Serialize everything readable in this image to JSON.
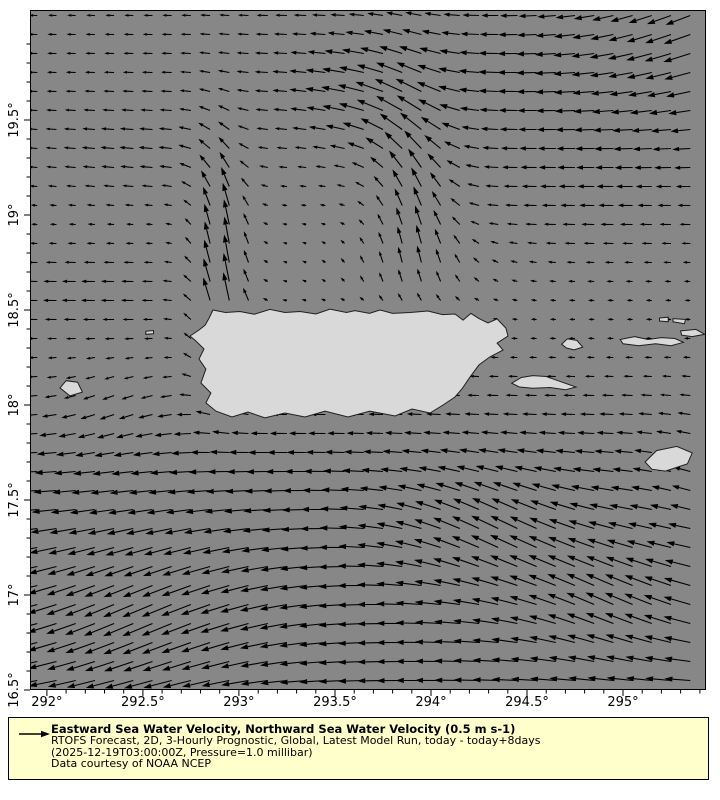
{
  "colors": {
    "page_bg": "#ffffff",
    "sea": "#878787",
    "land": "#d9d9d9",
    "coastline": "#1f1f1f",
    "arrow": "#000000",
    "axis": "#000000",
    "legend_bg": "#ffffcc",
    "legend_border": "#000000",
    "text": "#000000"
  },
  "legend": {
    "title": "Eastward Sea Water Velocity, Northward Sea Water Velocity (0.5 m s-1)",
    "line2": "RTOFS Forecast, 2D, 3-Hourly Prognostic, Global, Latest Model Run, today - today+8days",
    "line3": "(2025-12-19T03:00:00Z, Pressure=1.0 millibar)",
    "line4": "Data courtesy of NOAA NCEP",
    "reference_speed_ms": 0.5
  },
  "chart_data": {
    "type": "quiver",
    "title": "",
    "xlabel": "",
    "ylabel": "",
    "grid": false,
    "x_axis": {
      "range": [
        291.912,
        295.432
      ],
      "tick_values": [
        292,
        292.5,
        293,
        293.5,
        294,
        294.5,
        295
      ],
      "tick_labels": [
        "292°",
        "292.5°",
        "293°",
        "293.5°",
        "294°",
        "294.5°",
        "295°"
      ],
      "minor_step": 0.1
    },
    "y_axis": {
      "range": [
        16.5,
        20.079
      ],
      "tick_values": [
        16.5,
        17,
        17.5,
        18,
        18.5,
        19,
        19.5
      ],
      "tick_labels": [
        "16.5°",
        "17°",
        "17.5°",
        "18°",
        "18.5°",
        "19°",
        "19.5°"
      ],
      "minor_step": 0.1
    },
    "vector_grid": {
      "lon_start": 291.95,
      "lon_step": 0.1,
      "lon_count": 35,
      "lat_start": 16.55,
      "lat_step": 0.1,
      "lat_count": 36
    },
    "arrow_scale_px_per_ms": 50,
    "field": {
      "background": {
        "u": -0.07,
        "v": 0.005
      },
      "features": [
        {
          "name": "caribbean-current",
          "type": "sigband_u",
          "A": -0.44,
          "lat0": 17.95,
          "r": 0.2
        },
        {
          "name": "sw-veer-bottom-left",
          "type": "gauss",
          "lon0": 292.5,
          "lat0": 16.9,
          "sx": 0.8,
          "sy": 0.5,
          "Au": -0.1,
          "Av": -0.26
        },
        {
          "name": "nw-band-southeast-1",
          "type": "gauss",
          "lon0": 294.35,
          "lat0": 17.35,
          "sx": 0.55,
          "sy": 0.33,
          "Au": -0.05,
          "Av": 0.24
        },
        {
          "name": "nw-band-southeast-2",
          "type": "gauss",
          "lon0": 295.0,
          "lat0": 16.95,
          "sx": 0.55,
          "sy": 0.33,
          "Au": -0.05,
          "Av": 0.22
        },
        {
          "name": "mona-passage-jet",
          "type": "jet_v",
          "A": 0.62,
          "lon0": 292.92,
          "sx": 0.14,
          "lat1": 18.15,
          "r1": 0.12,
          "lat2": 19.25,
          "r2": 0.18
        },
        {
          "name": "mona-jet-west-turn-low",
          "type": "gauss",
          "lon0": 292.2,
          "lat0": 18.6,
          "sx": 0.55,
          "sy": 0.25,
          "Au": -0.2,
          "Av": 0.0
        },
        {
          "name": "mona-jet-west-turn-high",
          "type": "gauss",
          "lon0": 292.45,
          "lat0": 19.3,
          "sx": 0.6,
          "sy": 0.3,
          "Au": -0.16,
          "Av": 0.02
        },
        {
          "name": "north-jet",
          "type": "jet_v",
          "A": 0.5,
          "lon0": 293.93,
          "sx": 0.22,
          "lat1": 18.8,
          "r1": 0.15,
          "lat2": 19.5,
          "r2": 0.25
        },
        {
          "name": "north-jet-nw-turn",
          "type": "gauss",
          "lon0": 293.75,
          "lat0": 19.6,
          "sx": 0.4,
          "sy": 0.33,
          "Au": -0.28,
          "Av": 0.1
        },
        {
          "name": "north-jet-feed",
          "type": "gauss",
          "lon0": 293.9,
          "lat0": 18.72,
          "sx": 0.45,
          "sy": 0.22,
          "Au": 0.02,
          "Av": 0.14
        },
        {
          "name": "top-westward-band",
          "type": "topband_u",
          "base": 0.1,
          "amp": 0.27,
          "lonC": 293.8,
          "lonR": 0.6,
          "lat0": 19.85,
          "sy": 0.55
        },
        {
          "name": "ne-corner-inflow",
          "type": "gauss",
          "lon0": 295.45,
          "lat0": 20.0,
          "sx": 0.6,
          "sy": 0.45,
          "Au": -0.12,
          "Av": -0.2
        },
        {
          "name": "west-coast-south-drift",
          "type": "gauss",
          "lon0": 292.35,
          "lat0": 17.95,
          "sx": 0.35,
          "sy": 0.28,
          "Au": 0.0,
          "Av": -0.1
        },
        {
          "name": "east-offshore-westward",
          "type": "gauss",
          "lon0": 294.9,
          "lat0": 19.15,
          "sx": 0.8,
          "sy": 0.45,
          "Au": -0.2,
          "Av": 0.0
        },
        {
          "name": "se-edge-ne-drift",
          "type": "gauss",
          "lon0": 295.45,
          "lat0": 17.6,
          "sx": 0.35,
          "sy": 0.35,
          "Au": 0.1,
          "Av": 0.09
        }
      ]
    },
    "land": [
      {
        "name": "puerto-rico",
        "points": [
          [
            292.865,
            18.5
          ],
          [
            292.93,
            18.487
          ],
          [
            293.005,
            18.492
          ],
          [
            293.08,
            18.478
          ],
          [
            293.161,
            18.503
          ],
          [
            293.24,
            18.487
          ],
          [
            293.318,
            18.492
          ],
          [
            293.4,
            18.479
          ],
          [
            293.474,
            18.505
          ],
          [
            293.56,
            18.487
          ],
          [
            293.604,
            18.497
          ],
          [
            293.68,
            18.482
          ],
          [
            293.734,
            18.5
          ],
          [
            293.8,
            18.482
          ],
          [
            293.891,
            18.487
          ],
          [
            293.984,
            18.495
          ],
          [
            294.06,
            18.476
          ],
          [
            294.125,
            18.479
          ],
          [
            294.167,
            18.447
          ],
          [
            294.208,
            18.482
          ],
          [
            294.25,
            18.455
          ],
          [
            294.297,
            18.432
          ],
          [
            294.344,
            18.453
          ],
          [
            294.39,
            18.405
          ],
          [
            294.401,
            18.363
          ],
          [
            294.344,
            18.326
          ],
          [
            294.375,
            18.289
          ],
          [
            294.307,
            18.253
          ],
          [
            294.25,
            18.211
          ],
          [
            294.203,
            18.147
          ],
          [
            294.161,
            18.084
          ],
          [
            294.125,
            18.042
          ],
          [
            294.063,
            18.0
          ],
          [
            293.995,
            17.958
          ],
          [
            293.901,
            17.979
          ],
          [
            293.813,
            17.942
          ],
          [
            293.682,
            17.968
          ],
          [
            293.568,
            17.937
          ],
          [
            293.448,
            17.968
          ],
          [
            293.344,
            17.937
          ],
          [
            293.24,
            17.958
          ],
          [
            293.135,
            17.932
          ],
          [
            293.047,
            17.963
          ],
          [
            292.964,
            17.937
          ],
          [
            292.88,
            17.968
          ],
          [
            292.828,
            18.011
          ],
          [
            292.854,
            18.063
          ],
          [
            292.802,
            18.116
          ],
          [
            292.828,
            18.189
          ],
          [
            292.792,
            18.242
          ],
          [
            292.818,
            18.295
          ],
          [
            292.776,
            18.337
          ],
          [
            292.745,
            18.363
          ],
          [
            292.792,
            18.395
          ],
          [
            292.824,
            18.42
          ],
          [
            292.843,
            18.455
          ]
        ]
      },
      {
        "name": "mona-island",
        "points": [
          [
            292.068,
            18.09
          ],
          [
            292.1,
            18.128
          ],
          [
            292.16,
            18.12
          ],
          [
            292.185,
            18.068
          ],
          [
            292.12,
            18.048
          ]
        ]
      },
      {
        "name": "desecheo-island",
        "points": [
          [
            292.515,
            18.388
          ],
          [
            292.555,
            18.392
          ],
          [
            292.555,
            18.375
          ],
          [
            292.515,
            18.372
          ]
        ]
      },
      {
        "name": "vieques",
        "points": [
          [
            294.42,
            18.115
          ],
          [
            294.47,
            18.145
          ],
          [
            294.53,
            18.155
          ],
          [
            294.6,
            18.15
          ],
          [
            294.67,
            18.125
          ],
          [
            294.755,
            18.095
          ],
          [
            294.7,
            18.08
          ],
          [
            294.62,
            18.092
          ],
          [
            294.53,
            18.088
          ],
          [
            294.46,
            18.095
          ]
        ]
      },
      {
        "name": "culebra",
        "points": [
          [
            294.68,
            18.32
          ],
          [
            294.71,
            18.348
          ],
          [
            294.76,
            18.34
          ],
          [
            294.79,
            18.305
          ],
          [
            294.745,
            18.29
          ],
          [
            294.705,
            18.3
          ]
        ]
      },
      {
        "name": "st-thomas-st-john",
        "points": [
          [
            294.985,
            18.345
          ],
          [
            295.06,
            18.36
          ],
          [
            295.13,
            18.345
          ],
          [
            295.2,
            18.355
          ],
          [
            295.27,
            18.35
          ],
          [
            295.315,
            18.33
          ],
          [
            295.25,
            18.312
          ],
          [
            295.17,
            18.322
          ],
          [
            295.08,
            18.312
          ],
          [
            295.0,
            18.322
          ]
        ]
      },
      {
        "name": "tortola",
        "points": [
          [
            295.3,
            18.39
          ],
          [
            295.38,
            18.398
          ],
          [
            295.425,
            18.372
          ],
          [
            295.36,
            18.36
          ],
          [
            295.305,
            18.368
          ]
        ]
      },
      {
        "name": "jost-van-dyke",
        "points": [
          [
            295.19,
            18.458
          ],
          [
            295.235,
            18.462
          ],
          [
            295.235,
            18.438
          ],
          [
            295.19,
            18.442
          ]
        ]
      },
      {
        "name": "virgin-gorda",
        "points": [
          [
            295.26,
            18.455
          ],
          [
            295.325,
            18.45
          ],
          [
            295.32,
            18.428
          ],
          [
            295.26,
            18.438
          ]
        ]
      },
      {
        "name": "st-croix",
        "points": [
          [
            295.115,
            17.7
          ],
          [
            295.175,
            17.76
          ],
          [
            295.28,
            17.782
          ],
          [
            295.36,
            17.748
          ],
          [
            295.335,
            17.69
          ],
          [
            295.22,
            17.652
          ],
          [
            295.15,
            17.662
          ]
        ]
      }
    ]
  }
}
